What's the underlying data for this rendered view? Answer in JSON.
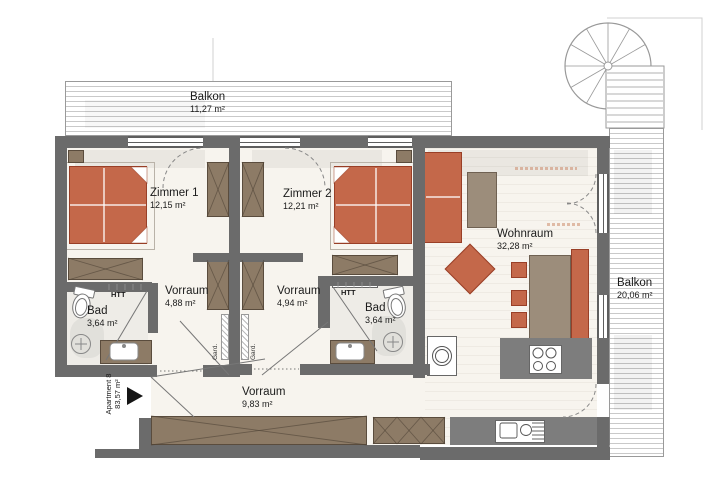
{
  "plan": {
    "rooms": [
      {
        "name": "Balkon",
        "area": "11,27 m²"
      },
      {
        "name": "Zimmer 1",
        "area": "12,15 m²"
      },
      {
        "name": "Zimmer 2",
        "area": "12,21 m²"
      },
      {
        "name": "Wohnraum",
        "area": "32,28 m²"
      },
      {
        "name": "Balkon",
        "area": "20,06 m²"
      },
      {
        "name": "Bad",
        "area": "3,64 m²"
      },
      {
        "name": "Vorraum",
        "area": "4,88 m²"
      },
      {
        "name": "Vorraum",
        "area": "4,94 m²"
      },
      {
        "name": "Bad",
        "area": "3,64 m²"
      },
      {
        "name": "Vorraum",
        "area": "9,83 m²"
      }
    ],
    "annotations": {
      "htt": "HTT",
      "gard": "Gard.",
      "apartment_name": "Apartment 8",
      "apartment_area": "83,57 m²"
    },
    "colors": {
      "wall": "#6b6b6b",
      "accent_orange": "#c4684a",
      "wood_brown": "#8d7b66",
      "counter_gray": "#7d7d7d",
      "floor": "#f7f4ee"
    }
  }
}
